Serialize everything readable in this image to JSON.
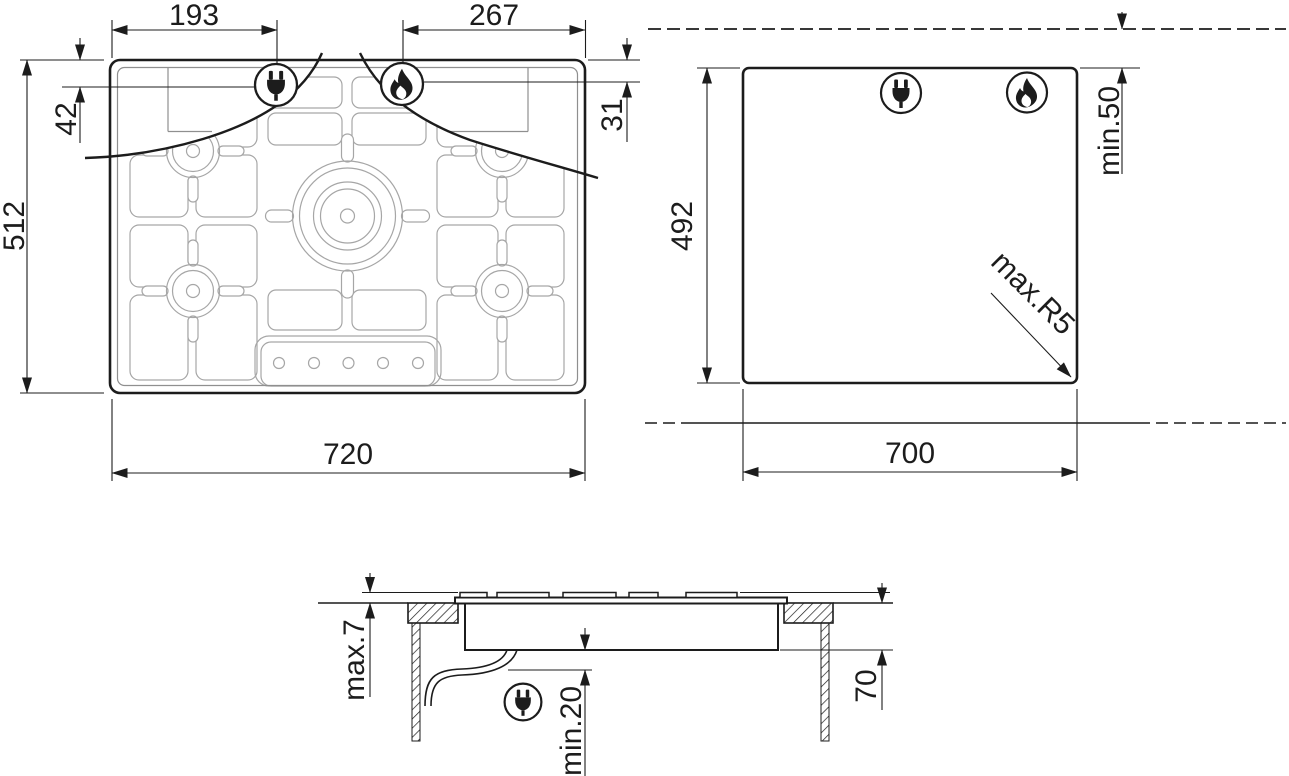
{
  "colors": {
    "ink": "#1c1c1c",
    "thin_gray": "#8f8f8f",
    "cell_gray": "#a6a6a6",
    "background": "#ffffff"
  },
  "icons": {
    "power_plug": "power-plug-icon",
    "gas_flame": "gas-flame-icon"
  },
  "drawing": {
    "top_view": {
      "width": "720",
      "depth": "512",
      "plug_offset_x": "193",
      "flame_offset_x": "267",
      "plug_offset_y": "42",
      "flame_offset_y": "31"
    },
    "cutout_view": {
      "width": "700",
      "depth": "492",
      "wall_clearance": "min.50",
      "corner_radius": "max.R5"
    },
    "side_view": {
      "protrusion": "max.7",
      "below_depth": "70",
      "clearance": "min.20"
    }
  }
}
